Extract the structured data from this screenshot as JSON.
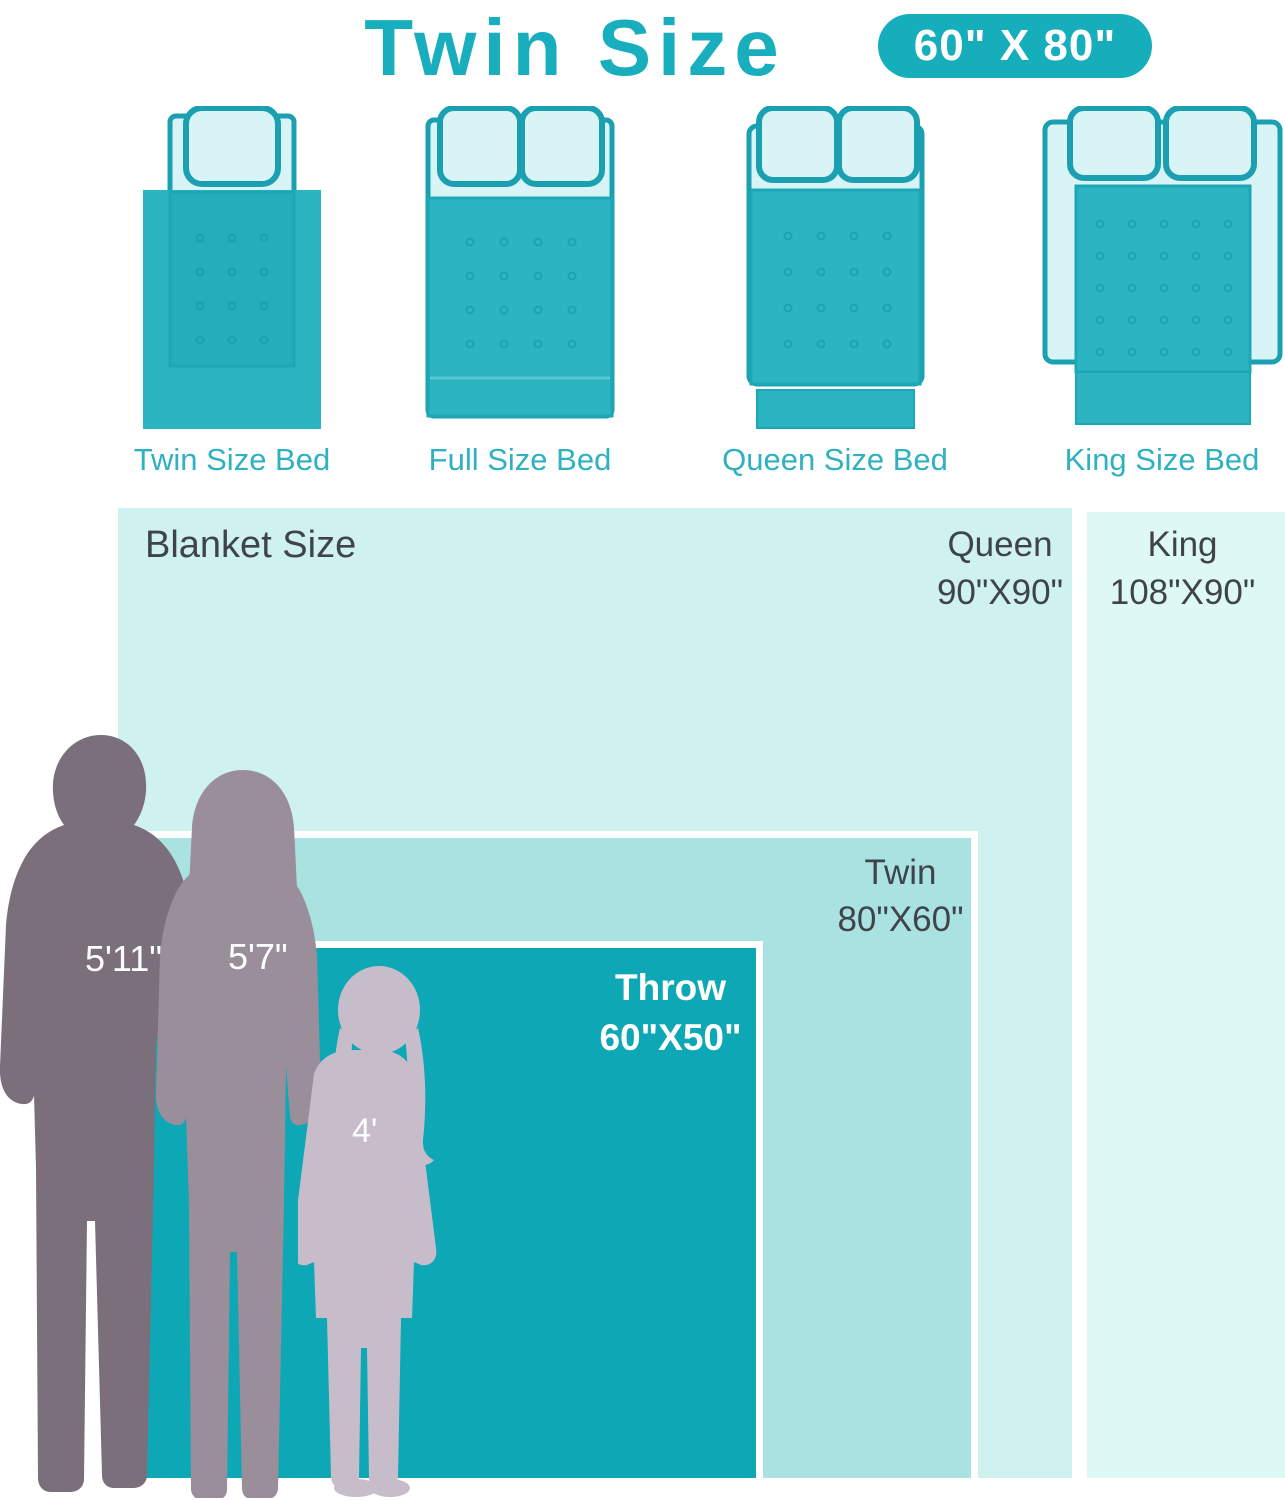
{
  "header": {
    "title": "Twin Size",
    "badge": "60\" X 80\""
  },
  "bed_row": {
    "beds": [
      {
        "label": "Twin Size Bed"
      },
      {
        "label": "Full Size Bed"
      },
      {
        "label": "Queen Size Bed"
      },
      {
        "label": "King Size Bed"
      }
    ]
  },
  "size_chart": {
    "panel_label": "Blanket Size",
    "sizes": [
      {
        "name": "King",
        "dimensions": "108\"X90\""
      },
      {
        "name": "Queen",
        "dimensions": "90\"X90\""
      },
      {
        "name": "Twin",
        "dimensions": "80\"X60\""
      },
      {
        "name": "Throw",
        "dimensions": "60\"X50\""
      }
    ],
    "people": [
      {
        "name": "man",
        "height": "5'11\""
      },
      {
        "name": "woman",
        "height": "5'7\""
      },
      {
        "name": "girl",
        "height": "4'"
      }
    ]
  },
  "colors": {
    "teal_accent": "#17aebc",
    "throw_area": "#0ea7b5",
    "twin_area": "#a9e2e1",
    "queen_area": "#cff1f0",
    "king_area": "#def8f5",
    "bed_light": "#d8f4f6",
    "bed_stroke": "#1aa0b0",
    "blanket": "#2cb4c2",
    "man_silhouette": "#7c6f7c",
    "woman_silhouette": "#9b8e9b",
    "girl_silhouette": "#c7bdca",
    "dark_text": "#3e444a"
  }
}
